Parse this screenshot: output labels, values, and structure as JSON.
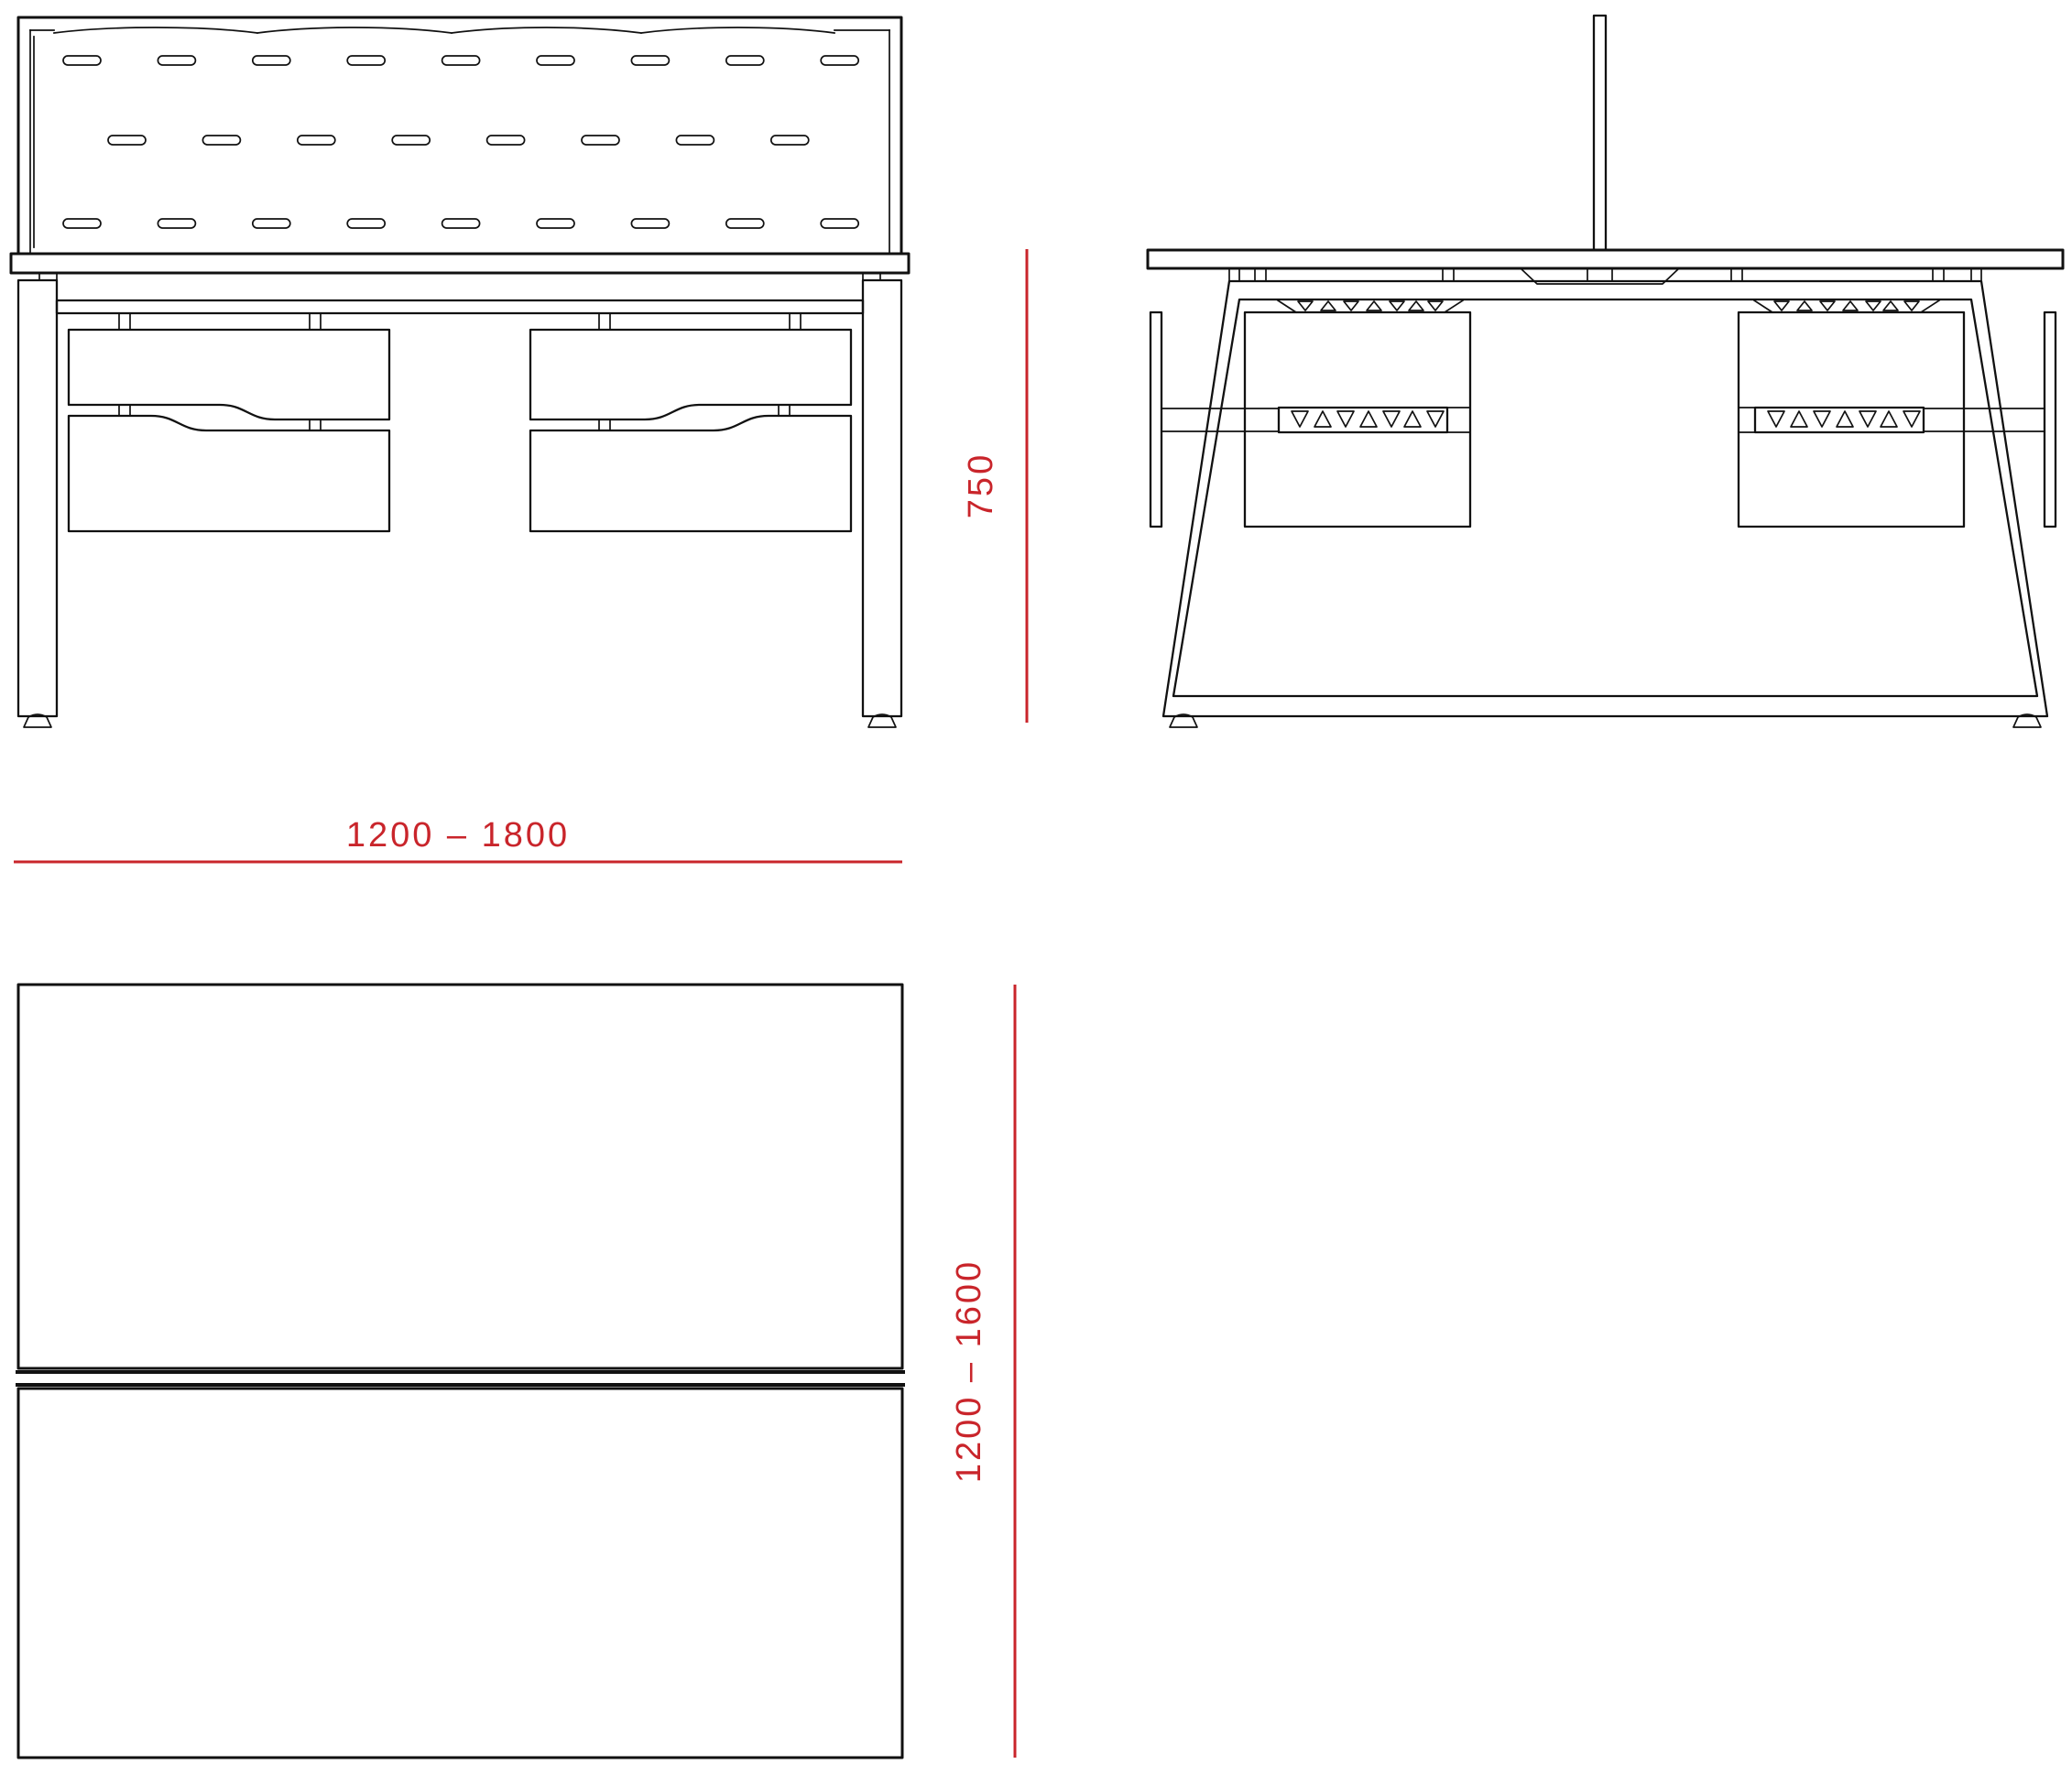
{
  "document": {
    "background": "#ffffff",
    "line_color": "#111111",
    "accent_color": "#c9252b"
  },
  "views": {
    "front": "front elevation of bench desk with perforated screen and two drawer pedestals",
    "side": "side elevation with A-frame leg, centre screen and pedestal",
    "plan": "plan view of double desktop with centre screen"
  },
  "dimensions": {
    "width_range": "1200 – 1800",
    "height": "750",
    "depth_range": "1200 – 1600"
  }
}
